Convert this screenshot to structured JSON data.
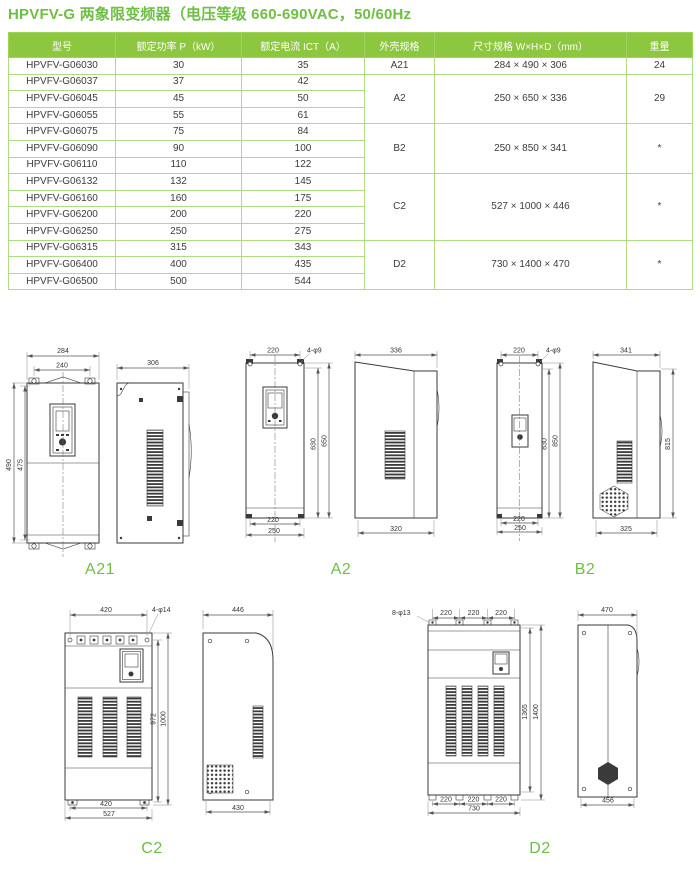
{
  "title": "HPVFV-G 两象限变频器（电压等级 660-690VAC，50/60Hz",
  "colors": {
    "accent_green": "#6ebf43",
    "header_bg": "#8dc63f",
    "border_green": "#aedb84"
  },
  "table": {
    "headers": [
      "型号",
      "额定功率 P（kW）",
      "额定电流 ICT（A）",
      "外壳规格",
      "尺寸规格 W×H×D（mm）",
      "重量"
    ],
    "rows": [
      {
        "model": "HPVFV-G06030",
        "power": "30",
        "current": "35"
      },
      {
        "model": "HPVFV-G06037",
        "power": "37",
        "current": "42"
      },
      {
        "model": "HPVFV-G06045",
        "power": "45",
        "current": "50"
      },
      {
        "model": "HPVFV-G06055",
        "power": "55",
        "current": "61"
      },
      {
        "model": "HPVFV-G06075",
        "power": "75",
        "current": "84"
      },
      {
        "model": "HPVFV-G06090",
        "power": "90",
        "current": "100"
      },
      {
        "model": "HPVFV-G06110",
        "power": "110",
        "current": "122"
      },
      {
        "model": "HPVFV-G06132",
        "power": "132",
        "current": "145"
      },
      {
        "model": "HPVFV-G06160",
        "power": "160",
        "current": "175"
      },
      {
        "model": "HPVFV-G06200",
        "power": "200",
        "current": "220"
      },
      {
        "model": "HPVFV-G06250",
        "power": "250",
        "current": "275"
      },
      {
        "model": "HPVFV-G06315",
        "power": "315",
        "current": "343"
      },
      {
        "model": "HPVFV-G06400",
        "power": "400",
        "current": "435"
      },
      {
        "model": "HPVFV-G06500",
        "power": "500",
        "current": "544"
      }
    ],
    "groups": [
      {
        "frame": "A21",
        "dims": "284 × 490 × 306",
        "weight": "24"
      },
      {
        "frame": "A2",
        "dims": "250 × 650 × 336",
        "weight": "29"
      },
      {
        "frame": "B2",
        "dims": "250 × 850 × 341",
        "weight": "*"
      },
      {
        "frame": "C2",
        "dims": "527 × 1000 × 446",
        "weight": "*"
      },
      {
        "frame": "D2",
        "dims": "730 × 1400 × 470",
        "weight": "*"
      }
    ]
  },
  "figures": {
    "a21": {
      "label": "A21",
      "top_w1": "284",
      "top_w2": "240",
      "left_h1": "490",
      "left_h2": "475",
      "side_w": "306"
    },
    "a2": {
      "label": "A2",
      "top_w": "220",
      "holes": "4-φ9",
      "right_h1": "630",
      "right_h2": "650",
      "bottom_w1": "220",
      "bottom_w2": "250",
      "side_top": "336",
      "side_bottom": "320"
    },
    "b2": {
      "label": "B2",
      "top_w": "220",
      "holes": "4-φ9",
      "right_h1": "830",
      "right_h2": "850",
      "bottom_w1": "220",
      "bottom_w2": "250",
      "side_top": "341",
      "side_h": "815",
      "side_bottom": "325"
    },
    "c2": {
      "label": "C2",
      "top_w": "420",
      "holes": "4-φ14",
      "right_h1": "972",
      "right_h2": "1000",
      "bottom_w1": "420",
      "bottom_w2": "527",
      "side_top": "446",
      "side_bottom": "430"
    },
    "d2": {
      "label": "D2",
      "holes": "8-φ13",
      "seg": "220",
      "right_h1": "1365",
      "right_h2": "1400",
      "bottom_total": "730",
      "side_top": "470",
      "side_bottom": "456"
    }
  }
}
